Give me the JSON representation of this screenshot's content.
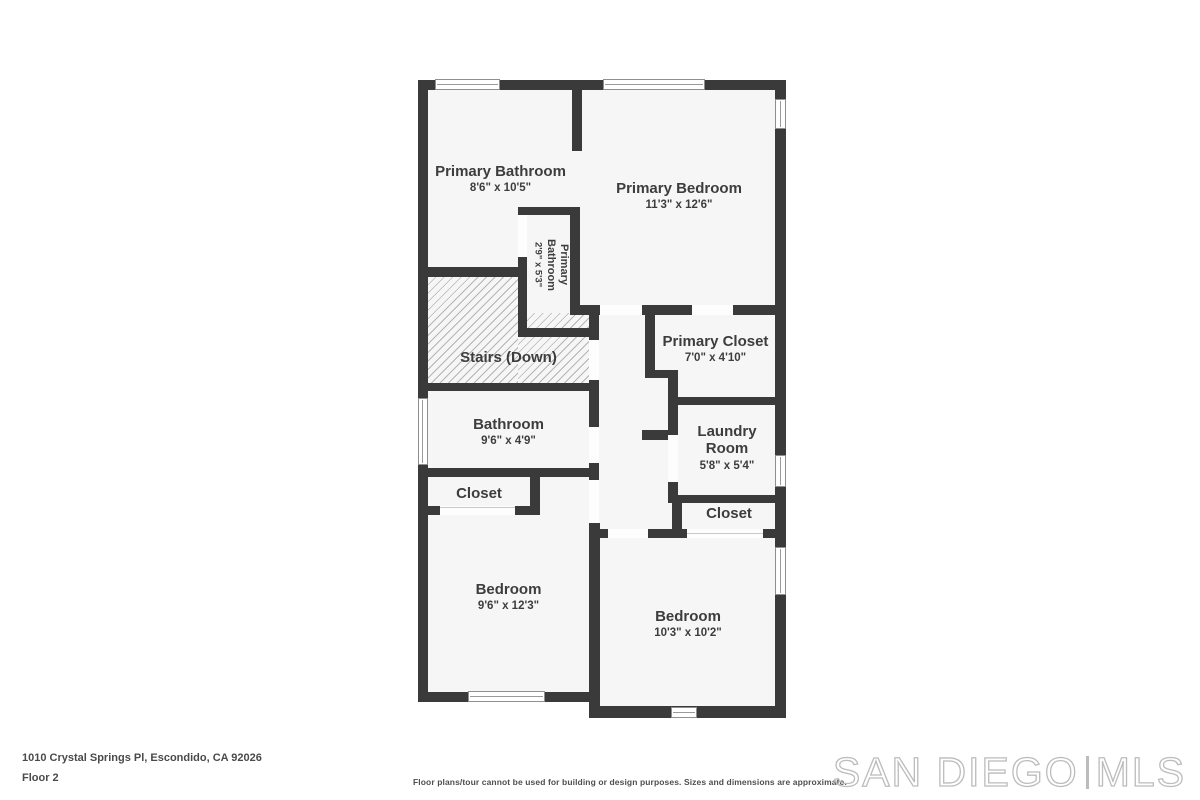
{
  "rooms": {
    "primary_bathroom": {
      "name": "Primary Bathroom",
      "dims": "8'6\" x 10'5\""
    },
    "primary_bedroom": {
      "name": "Primary Bedroom",
      "dims": "11'3\" x 12'6\""
    },
    "primary_bathroom_small": {
      "name": "Primary Bathroom",
      "dims": "2'9\" x 5'3\""
    },
    "stairs": {
      "name": "Stairs (Down)"
    },
    "primary_closet": {
      "name": "Primary Closet",
      "dims": "7'0\" x 4'10\""
    },
    "bathroom": {
      "name": "Bathroom",
      "dims": "9'6\" x 4'9\""
    },
    "laundry": {
      "name": "Laundry Room",
      "dims": "5'8\" x 5'4\""
    },
    "closet_left": {
      "name": "Closet"
    },
    "closet_right": {
      "name": "Closet"
    },
    "bedroom_left": {
      "name": "Bedroom",
      "dims": "9'6\" x 12'3\""
    },
    "bedroom_right": {
      "name": "Bedroom",
      "dims": "10'3\" x 10'2\""
    }
  },
  "footer": {
    "address": "1010 Crystal Springs Pl, Escondido, CA 92026",
    "floor": "Floor 2",
    "disclaimer": "Floor plans/tour cannot be used for building or design purposes. Sizes and dimensions are approximate."
  },
  "watermark": {
    "brand": "SAN DIEGO",
    "suffix": "MLS"
  },
  "colors": {
    "wall": "#3a3a3a",
    "room_fill": "#f6f6f6",
    "label_text": "#3d3d3d",
    "watermark": "#bcbcbc"
  }
}
